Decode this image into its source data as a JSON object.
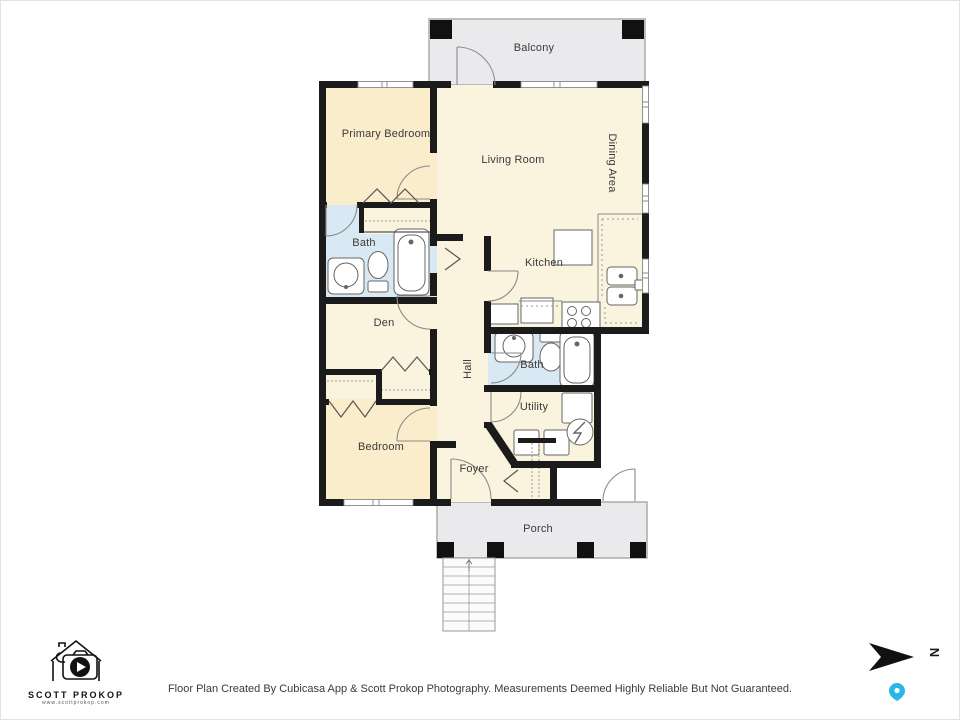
{
  "rooms": {
    "balcony": "Balcony",
    "primary_bedroom": "Primary Bedroom",
    "living_room": "Living Room",
    "dining_area": "Dining Area",
    "bath1": "Bath",
    "kitchen": "Kitchen",
    "den": "Den",
    "hall": "Hall",
    "bath2": "Bath",
    "utility": "Utility",
    "bedroom": "Bedroom",
    "foyer": "Foyer",
    "porch": "Porch"
  },
  "footer": {
    "disclaimer": "Floor Plan Created By Cubicasa App & Scott Prokop Photography. Measurements Deemed Highly Reliable But Not Guaranteed."
  },
  "logo": {
    "name": "SCOTT PROKOP",
    "url": "www.scottprokop.com"
  },
  "compass": {
    "letter": "N"
  },
  "colors": {
    "wall": "#1b1b1b",
    "room_cream": "#FAF3DD",
    "room_tan": "#FAEDCB",
    "bath_blue": "#D9E9F3",
    "outdoor_gray": "#EAEAEC",
    "pin_blue": "#29B6E8"
  }
}
